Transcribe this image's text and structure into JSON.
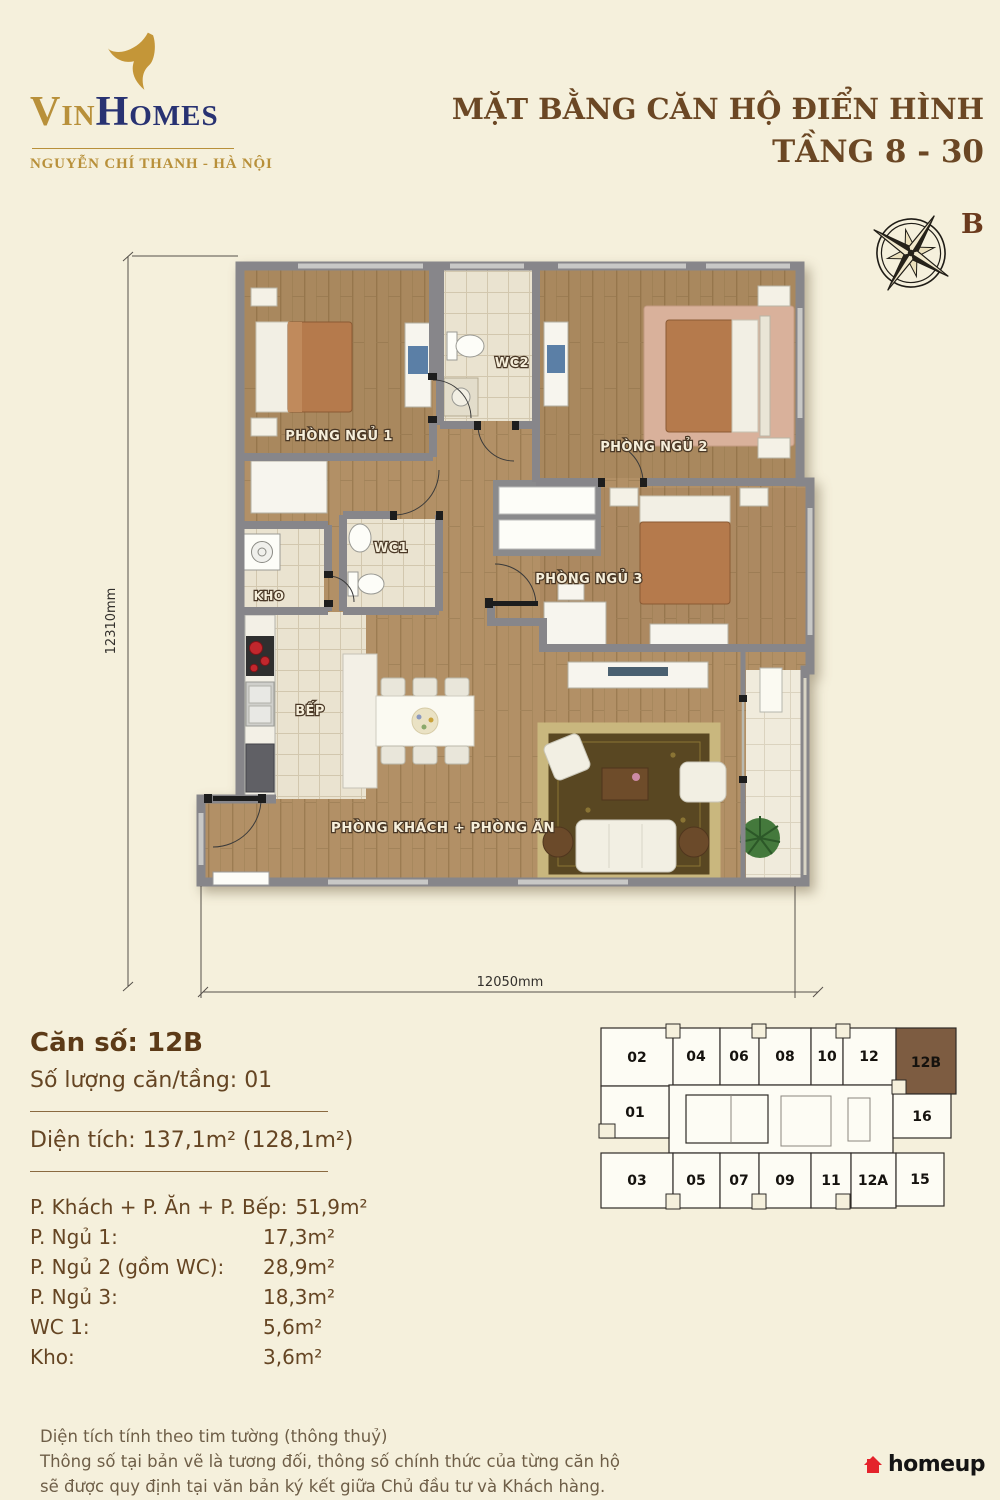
{
  "page": {
    "background": "#f5f0dc"
  },
  "brand": {
    "name_vin": "Vin",
    "name_homes": "Homes",
    "subtitle": "NGUYỄN CHÍ THANH - HÀ NỘI",
    "gold": "#b8903a",
    "navy": "#283272"
  },
  "header": {
    "title_line1": "MẶT BẰNG CĂN HỘ ĐIỂN HÌNH",
    "title_line2": "TẦNG 8 - 30",
    "title_color": "#6b4724",
    "compass_label": "B"
  },
  "plan": {
    "rooms": [
      "PHÒNG NGỦ 1",
      "WC2",
      "PHÒNG NGỦ 2",
      "WC1",
      "KHO",
      "PHÒNG NGỦ 3",
      "BẾP",
      "PHÒNG KHÁCH + PHÒNG ĂN"
    ],
    "dim_left": "12310mm",
    "dim_bottom": "12050mm"
  },
  "unit_info": {
    "unit_number": "Căn số: 12B",
    "quantity": "Số lượng căn/tầng: 01",
    "area": "Diện tích: 137,1m² (128,1m²)",
    "rows": [
      {
        "label": "P. Khách + P. Ăn + P. Bếp:",
        "value": "51,9m²"
      },
      {
        "label": "P. Ngủ 1:",
        "value": "17,3m²"
      },
      {
        "label": "P. Ngủ 2 (gồm WC):",
        "value": "28,9m²"
      },
      {
        "label": "P. Ngủ 3:",
        "value": "18,3m²"
      },
      {
        "label": "WC 1:",
        "value": "5,6m²"
      },
      {
        "label": "Kho:",
        "value": "3,6m²"
      }
    ]
  },
  "keyplan": {
    "units": [
      "02",
      "04",
      "06",
      "08",
      "10",
      "12",
      "12B",
      "01",
      "16",
      "03",
      "05",
      "07",
      "09",
      "11",
      "12A",
      "15"
    ],
    "highlighted_unit": "12B",
    "highlight_color": "#7d5c41"
  },
  "footer": {
    "lines": [
      "Diện tích tính theo tim tường (thông thuỷ)",
      "Thông số tại bản vẽ là tương đối, thông số chính thức của từng căn hộ",
      "sẽ được quy định tại văn bản ký kết giữa Chủ đầu tư và Khách hàng."
    ]
  },
  "credit": {
    "label": "homeup",
    "icon_color": "#e4232b"
  }
}
